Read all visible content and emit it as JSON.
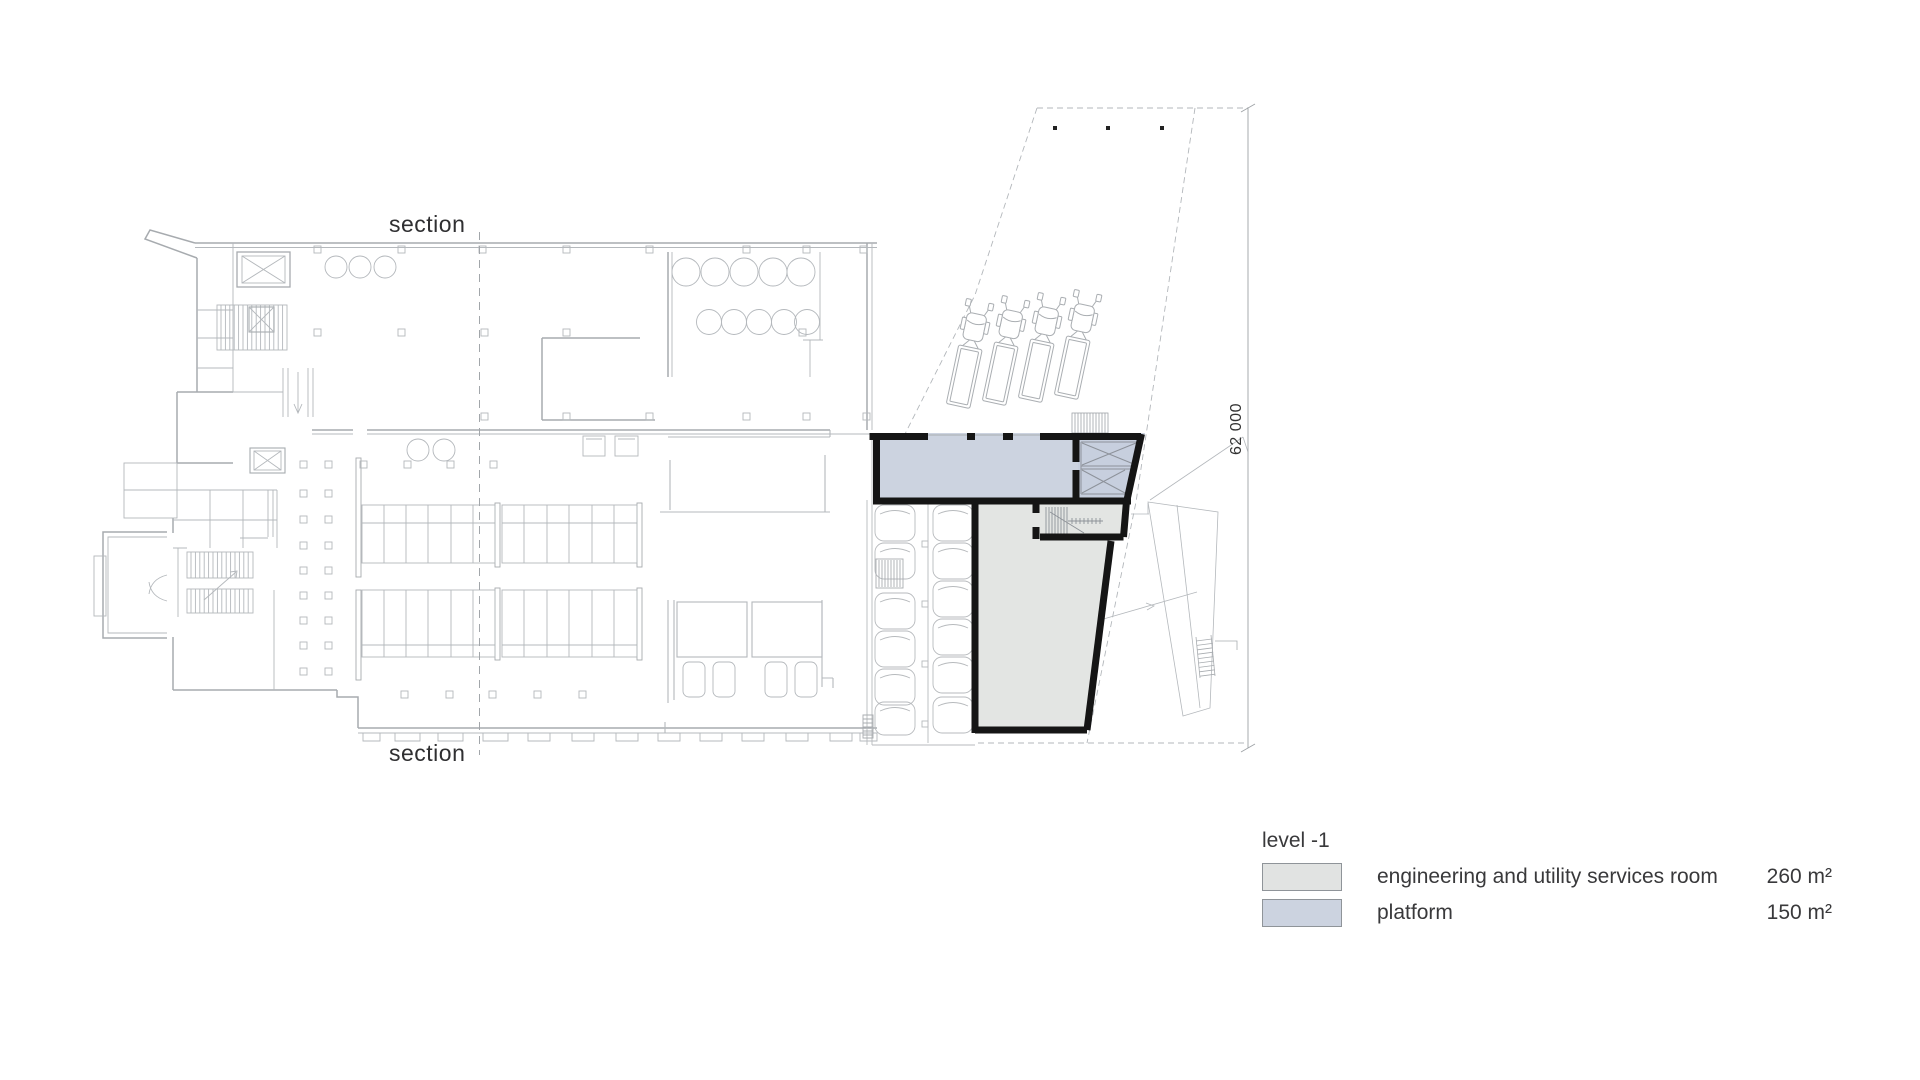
{
  "drawing": {
    "type": "architectural floor plan",
    "section_label_top": "section",
    "section_label_bottom": "section",
    "dimension_value": "62 000"
  },
  "legend": {
    "title": "level -1",
    "items": [
      {
        "label": "engineering and utility services room",
        "area": "260 m²",
        "color": "#e1e3e2"
      },
      {
        "label": "platform",
        "area": "150 m²",
        "color": "#ccd3e0"
      }
    ]
  },
  "colors": {
    "bold_wall": "#151515",
    "platform_fill": "#ccd3e0",
    "shaft_fill": "#c7cfde",
    "room_fill": "#e3e5e3",
    "faint_line": "#b4b8bc",
    "text": "#39393b"
  }
}
